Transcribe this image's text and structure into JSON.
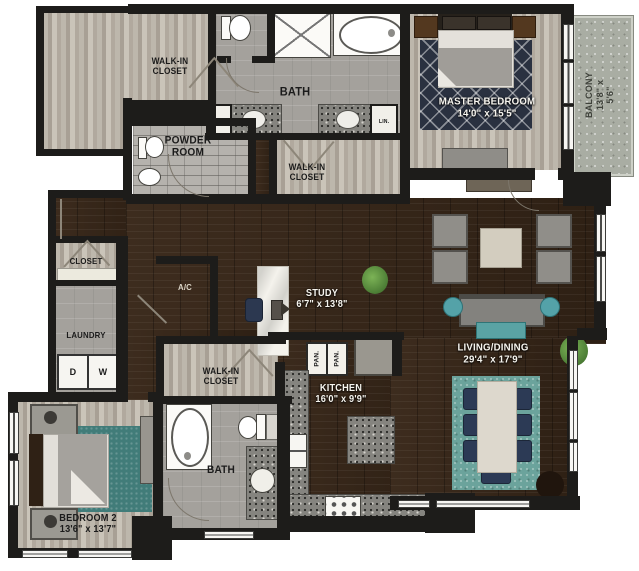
{
  "rooms": {
    "walk_in_closet_top": "WALK-IN\nCLOSET",
    "master_bath": "BATH",
    "linen_left": "LIN.",
    "linen_right": "LIN.",
    "powder_room": "POWDER\nROOM",
    "walk_in_closet_master": "WALK-IN\nCLOSET",
    "master_bedroom": "MASTER BEDROOM\n14'0\" x 15'5\"",
    "balcony": "BALCONY\n13'8\" x 5'6\"",
    "hall_closet": "CLOSET",
    "laundry": "LAUNDRY",
    "dryer": "D",
    "washer": "W",
    "ac": "A/C",
    "study": "STUDY\n6'7\" x 13'8\"",
    "pantry_1": "PAN.",
    "pantry_2": "PAN.",
    "walk_in_closet_bed2": "WALK-IN\nCLOSET",
    "kitchen": "KITCHEN\n16'0\" x 9'9\"",
    "living_dining": "LIVING/DINING\n29'4\" x 17'9\"",
    "bath_2": "BATH",
    "bedroom_2": "BEDROOM 2\n13'6\" x 13'7\""
  },
  "colors": {
    "wall": "#1d1c1a",
    "wood_dark": "#36261a",
    "wood_light": "#b6b0a5",
    "tile_gray": "#a4a19c",
    "granite": "#85847f",
    "accent_teal": "#57a3a8",
    "rug_navy": "#2a3140",
    "rug_teal": "#417c79",
    "balcony_concrete": "#a9ada3"
  }
}
